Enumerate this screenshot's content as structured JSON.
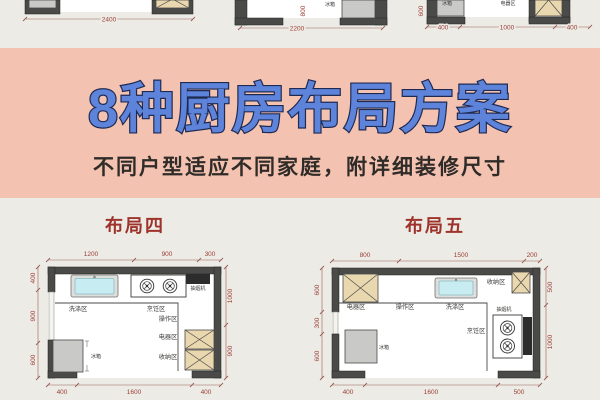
{
  "page": {
    "title": "8种厨房布局方案",
    "subtitle": "不同户型适应不同家庭，附详细装修尺寸",
    "colors": {
      "band_pink": "#f4c2b0",
      "background": "#edebe6",
      "title_blue": "#5d84da",
      "title_outline": "#1e2a52",
      "section_red": "#9e332b",
      "dimension_red": "#9c4036",
      "wall_gray": "#4a4a48",
      "cabinet_beige": "#e9d7af",
      "fridge_gray": "#c9c9c8",
      "sink_blue": "#c7ecf1",
      "hood_black": "#2c2c2c"
    }
  },
  "top_strip": {
    "plan_a": {
      "bottom_dim": "2400"
    },
    "plan_b": {
      "bottom_dim": "2200",
      "inner_dim": "800",
      "fridge_label": "冰箱"
    },
    "plan_c": {
      "bottom_dims": [
        "400",
        "1000",
        "400"
      ],
      "side_dim": "600",
      "fridge_label": "冰箱",
      "cabinet_label": "电器区"
    }
  },
  "layout4": {
    "name": "布局四",
    "top_dims": [
      "1200",
      "900",
      "300"
    ],
    "left_dims": [
      "400",
      "900",
      "600"
    ],
    "right_dims": [
      "1000",
      "900"
    ],
    "bottom_dims": [
      "400",
      "1600",
      "400"
    ],
    "labels": {
      "wash": "洗涤区",
      "cook": "烹饪区",
      "prep": "操作区",
      "appliance": "电器区",
      "storage": "收纳区",
      "fridge": "冰箱",
      "hood": "抽烟机"
    }
  },
  "layout5": {
    "name": "布局五",
    "top_dims": [
      "800",
      "1500",
      "200"
    ],
    "left_dims": [
      "600",
      "300",
      "600"
    ],
    "right_dims": [
      "500",
      "1000"
    ],
    "bottom_dims": [
      "400",
      "1600",
      "500"
    ],
    "labels": {
      "appliance": "电器区",
      "prep": "操作区",
      "wash": "洗涤区",
      "storage": "收纳区",
      "hood": "抽烟机",
      "cook": "烹饪区",
      "fridge": "冰箱"
    }
  }
}
